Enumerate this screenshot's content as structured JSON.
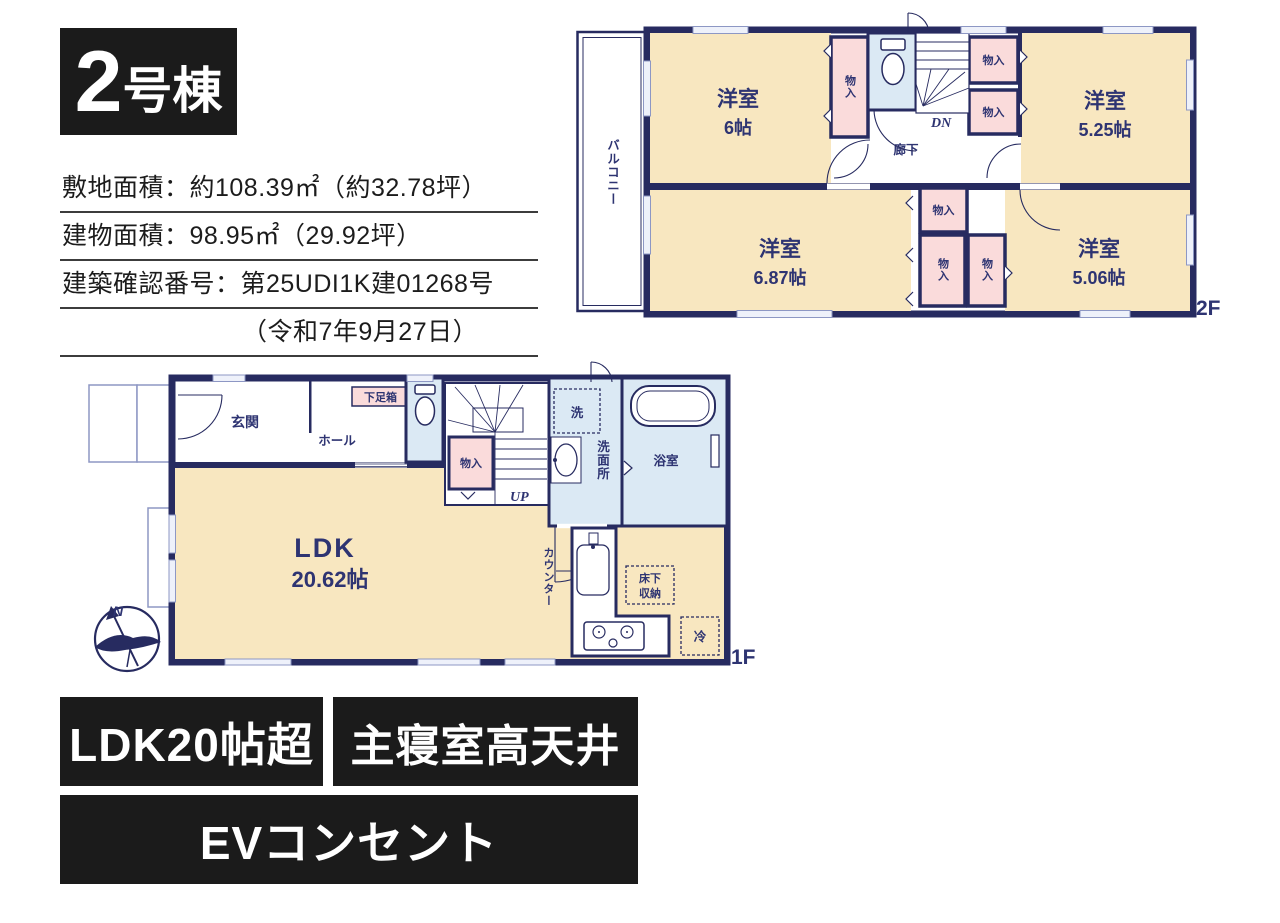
{
  "title": {
    "number": "2",
    "suffix": "号棟"
  },
  "info_lines": [
    "敷地面積：約108.39㎡（約32.78坪）",
    "建物面積：98.95㎡（29.92坪）",
    "建築確認番号：第25UDI1K建01268号",
    "（令和7年9月27日）"
  ],
  "floor2": {
    "floor_label": "2F",
    "balcony": "バルコニー",
    "corridor": "廊下",
    "stairs_dn": "DN",
    "closet": "物入",
    "rooms": [
      {
        "name": "洋室",
        "size": "6帖"
      },
      {
        "name": "洋室",
        "size": "5.25帖"
      },
      {
        "name": "洋室",
        "size": "6.87帖"
      },
      {
        "name": "洋室",
        "size": "5.06帖"
      }
    ]
  },
  "floor1": {
    "floor_label": "1F",
    "entrance": "玄関",
    "hall": "ホール",
    "shoe_box": "下足箱",
    "closet": "物入",
    "stairs_up": "UP",
    "washer": "洗",
    "washroom": "洗面所",
    "bathroom": "浴室",
    "ldk_name": "LDK",
    "ldk_size": "20.62帖",
    "counter": "カウンター",
    "underfloor_storage_line1": "床下",
    "underfloor_storage_line2": "収納",
    "fridge": "冷",
    "compass_north": "N"
  },
  "badges": [
    "LDK20帖超",
    "主寝室高天井",
    "EVコンセント"
  ],
  "colors": {
    "wall_navy": "#272b60",
    "text_navy": "#2e3472",
    "room_cream": "#f8e7c0",
    "closet_pink": "#fadbdb",
    "wet_area_blue": "#dbe9f4",
    "badge_black": "#1b1b1b"
  }
}
